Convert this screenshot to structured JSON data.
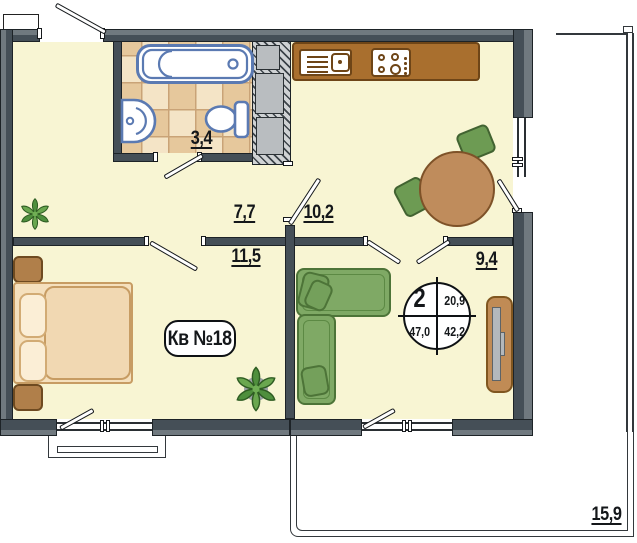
{
  "apartment": {
    "badge": "Кв №18"
  },
  "areas": {
    "bathroom": "3,4",
    "hallway": "7,7",
    "kitchen": "10,2",
    "bedroom": "11,5",
    "living_room": "9,4",
    "terrace": "15,9"
  },
  "info_circle": {
    "top_left": "2",
    "top_right": "20,9",
    "bottom_left": "47,0",
    "bottom_right": "42,2"
  },
  "palette": {
    "floor": "#f8f5d3",
    "wall_dark": "#454f57",
    "wall_light": "#70797f",
    "tile_light": "#f4e4c6",
    "tile_dark": "#e6c89c",
    "fixture_blue": "#5b7ab2",
    "counter_brown": "#a96f2e",
    "table_brown": "#bf8c5c",
    "furniture_green": "#7fa965",
    "bed_tan": "#f3dcb8"
  }
}
